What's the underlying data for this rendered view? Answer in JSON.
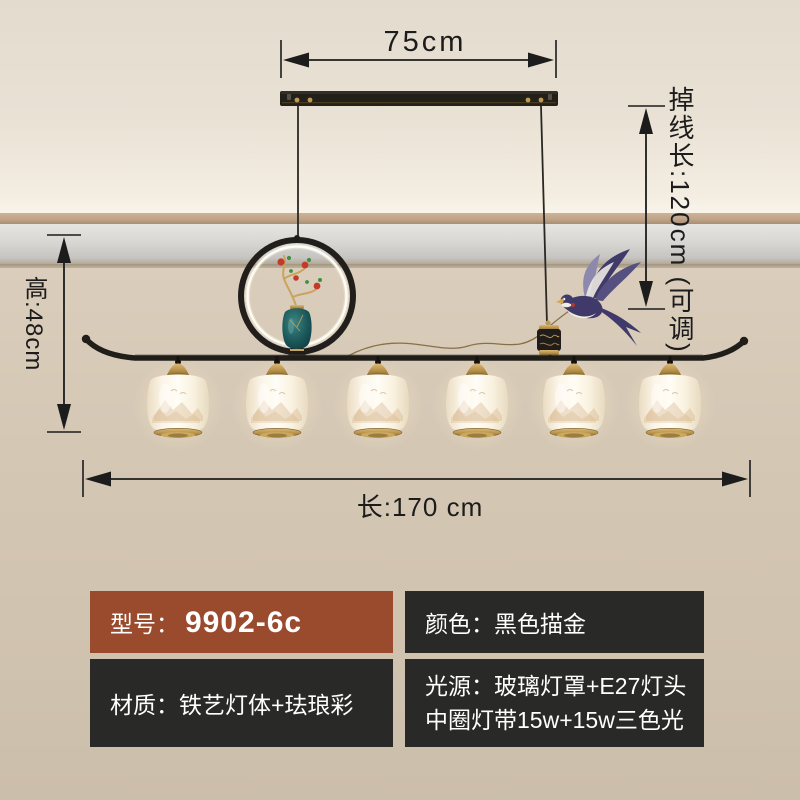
{
  "dimensions": {
    "top_width_label": "75cm",
    "drop_length_label": "掉线长:120cm (可调)",
    "height_label": "高:48cm",
    "total_length_label": "长:170 cm"
  },
  "spec_table": {
    "model": {
      "label": "型号：",
      "value": "9902-6c"
    },
    "color": {
      "label": "颜色：",
      "value": "黑色描金"
    },
    "material": {
      "label": "材质：",
      "value": "铁艺灯体+珐琅彩"
    },
    "light_source": {
      "label": "光源：",
      "value_line1": "玻璃灯罩+E27灯头",
      "value_line2": "中圈灯带15w+15w三色光"
    }
  },
  "product": {
    "lamp_count": 6,
    "style": "new-chinese pendant lamp with halo ring, enamel vase, swallow and six glass lantern shades"
  },
  "colors": {
    "wall": "#d4c7b4",
    "ceiling": "#e9e1d4",
    "fixture_black": "#211e1a",
    "fixture_gold": "#c09a55",
    "shade_white": "#fffdf6",
    "vase_teal": "#1d5a5c",
    "table_brown": "#9a4a2d",
    "table_dark": "#292927",
    "dim_line": "#1c1c1c"
  }
}
